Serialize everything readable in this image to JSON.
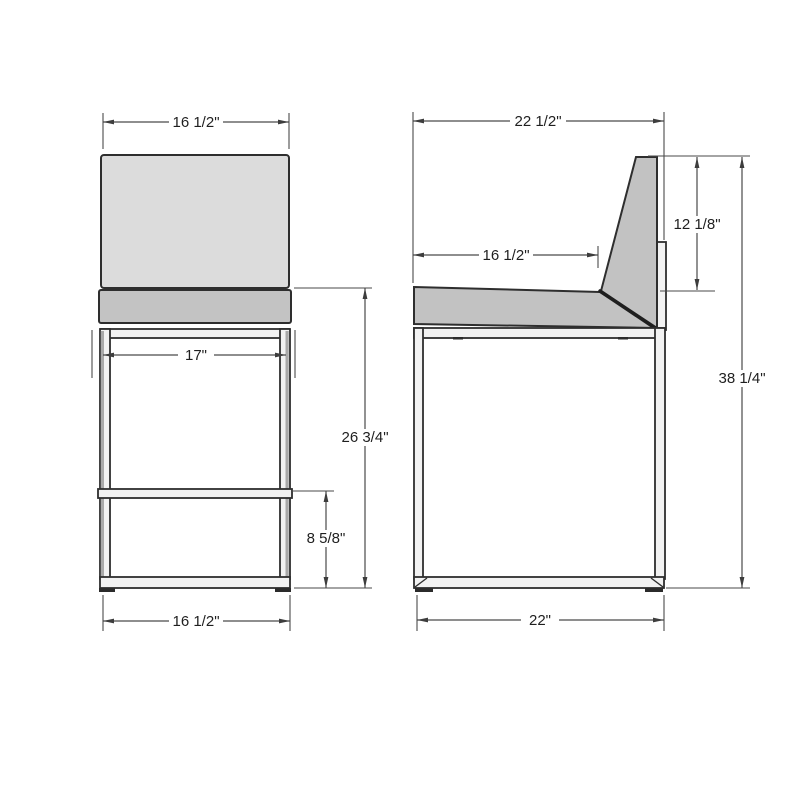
{
  "drawing_type": "furniture-dimension-drawing",
  "colors": {
    "background": "#ffffff",
    "outline": "#2e2e2e",
    "dimension_line": "#4a4a4a",
    "text": "#1f1f1f",
    "backrest_fill": "#dcdcdc",
    "seat_fill": "#c3c3c3",
    "side_upholstery_fill": "#c2c2c2",
    "frame_fill": "#f2f2f2"
  },
  "front_view": {
    "top_width": "16 1/2\"",
    "leg_span": "17\"",
    "seat_height": "26 3/4\"",
    "footrest_height": "8 5/8\"",
    "base_width": "16 1/2\""
  },
  "side_view": {
    "overall_depth": "22 1/2\"",
    "seat_depth": "16 1/2\"",
    "backrest_height": "12 1/8\"",
    "overall_height": "38 1/4\"",
    "base_depth": "22\""
  }
}
